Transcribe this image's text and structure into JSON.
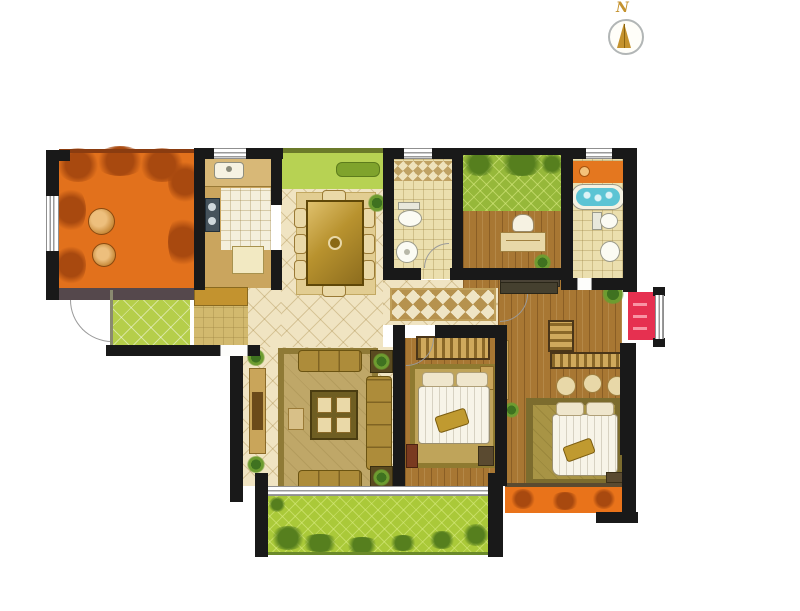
{
  "title": "apartment-floor-plan",
  "compass": {
    "label": "N"
  },
  "palette": {
    "wall": "#191919",
    "terrace_orange": "#e2711c",
    "terrace_wall": "#55484c",
    "porch_lime": "#b5ce4a",
    "cabinet_mustard": "#c3932f",
    "entry_khaki": "#d2b96e",
    "counter_tan": "#caa55e",
    "kitchen_tile": "#f4efdc",
    "stove_gray": "#46535c",
    "flowerbed_green": "#b7d253",
    "bench_green": "#7fa32c",
    "cream_tile": "#f0e4c2",
    "table_gold": "#b8922e",
    "chair_cream": "#ead9a8",
    "bath_tile": "#ebdfae",
    "garden_green": "#96b83a",
    "wood_brown": "#a87733",
    "shelf_orange": "#e4771f",
    "tub_blue": "#5cc4d4",
    "closet_red": "#e63050",
    "rug_cream": "#efe5c5",
    "rug_diamond": "#c5a255",
    "sofa_gold": "#ad8c3a",
    "sofa_rug": "#bfa768",
    "bedroom_rug": "#bfa45a",
    "master_rug": "#a89445",
    "bed_white": "#f7f4e8",
    "balcony_green": "#aac939",
    "balcony_orange": "#e9731a"
  },
  "rooms": [
    {
      "name": "terrace",
      "fixtures": [
        "round-table",
        "stool",
        "foliage"
      ]
    },
    {
      "name": "entry-porch",
      "fixtures": [
        "tiled-floor"
      ]
    },
    {
      "name": "entry-hall",
      "fixtures": [
        "shoe-cabinet",
        "entry-door"
      ]
    },
    {
      "name": "kitchen",
      "fixtures": [
        "sink",
        "stove",
        "counter",
        "refrigerator"
      ]
    },
    {
      "name": "dining-room",
      "fixtures": [
        "dining-table",
        "chairs",
        "plant"
      ]
    },
    {
      "name": "flower-bed",
      "fixtures": [
        "bench",
        "lawn"
      ]
    },
    {
      "name": "bathroom-1",
      "fixtures": [
        "toilet",
        "washbasin",
        "mosaic-strip"
      ]
    },
    {
      "name": "study",
      "fixtures": [
        "desk",
        "chair",
        "plant",
        "roof-garden",
        "low-cabinet"
      ]
    },
    {
      "name": "bathroom-2",
      "fixtures": [
        "bathtub",
        "toilet",
        "washbasin",
        "shelf"
      ]
    },
    {
      "name": "red-cabinet-bay",
      "fixtures": [
        "cabinet",
        "window"
      ]
    },
    {
      "name": "hallway",
      "fixtures": [
        "runner-rug"
      ]
    },
    {
      "name": "living-room",
      "fixtures": [
        "sofa-set",
        "coffee-table",
        "tv-cabinet",
        "plants",
        "rug"
      ]
    },
    {
      "name": "bedroom-2",
      "fixtures": [
        "double-bed",
        "wardrobe",
        "rug",
        "nightstand"
      ]
    },
    {
      "name": "master-bedroom",
      "fixtures": [
        "double-bed",
        "wardrobe",
        "ottomans",
        "rug",
        "bench",
        "plants"
      ]
    },
    {
      "name": "south-balcony",
      "fixtures": [
        "shrubs",
        "picture-window"
      ]
    },
    {
      "name": "southeast-balcony",
      "fixtures": [
        "planters"
      ]
    }
  ]
}
